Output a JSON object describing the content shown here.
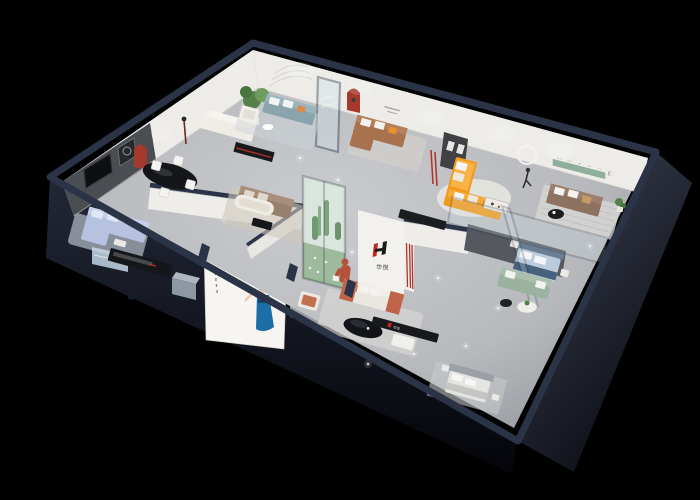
{
  "scene": {
    "description": "3D isometric cutaway rendering of a furniture showroom floor plan on a black background",
    "background": "#000000"
  },
  "brand": {
    "logo_mark": "H",
    "logo_text": "华悦",
    "wall_lettering": "H U A Y U E"
  },
  "palette": {
    "wall_top": "#2b3447",
    "white_wall": "#edece8",
    "dark_wall": "#4a4d52",
    "floor": "#c0c2c6",
    "red_niche": "#a5392c",
    "logo_red": "#c0271f",
    "orange_sofa": "#f29a1c",
    "brown_sofa": "#a8724e",
    "walnut_sofa": "#8d7260",
    "taupe_sofa": "#97806d",
    "teal_sofa": "#8aa4ad",
    "lavender_sofa": "#b6c2e0",
    "green_sofa": "#9cb2a0",
    "blue_bed": "#b9cbdc",
    "terracotta": "#bf6448",
    "plant_green": "#54804a",
    "glass": "#cfe0e6",
    "console_black": "#17191d",
    "poster_dress": "#1c6fa6",
    "rug_light": "#d8d8d6"
  }
}
